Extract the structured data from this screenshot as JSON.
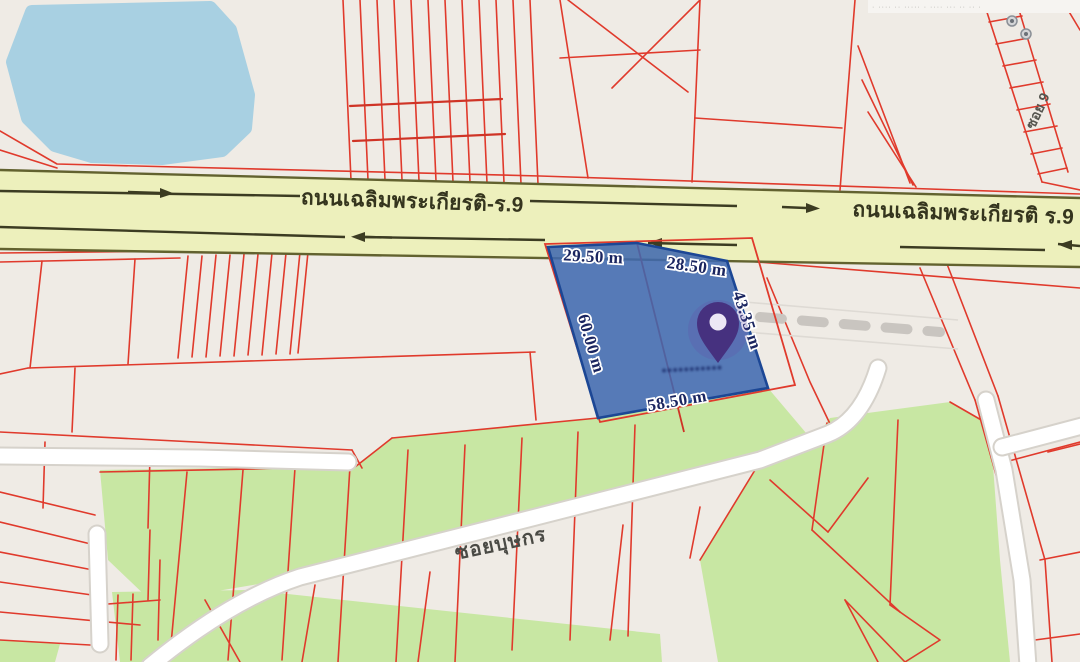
{
  "map": {
    "type": "cadastral-land-plot-map",
    "labels": {
      "road_left": "ถนนเฉลิมพระเกียรติ-ร.9",
      "road_right": "ถนนเฉลิมพระเกียรติ ร.9",
      "soi": "ซอยบุษกร",
      "side_soi": "ซอย 9",
      "watermark_top_right": "· ···· ·· ····· · ···· ··· ·· ·· ·",
      "pin_caption_blurred": "•••••••••••"
    },
    "parcel": {
      "dim_top_left": "29.50 m",
      "dim_top_right": "28.50 m",
      "dim_left": "60.00 m",
      "dim_right": "43.35 m",
      "dim_bottom": "58.50 m"
    },
    "icons": {
      "pin": "map-pin"
    },
    "colors": {
      "background": "#efebe5",
      "cadastral_line_red": "#e03a2c",
      "main_road_fill": "#edf0bc",
      "road_edge_olive": "#62622f",
      "pond_blue": "#a8d0e2",
      "greenery": "#c8e7a3",
      "minor_road_white": "#ffffff",
      "parcel_fill_blue": "#3f69b0",
      "parcel_outline": "#1c4795",
      "dimension_text": "#1a2560",
      "pin_purple": "#46317f"
    }
  }
}
